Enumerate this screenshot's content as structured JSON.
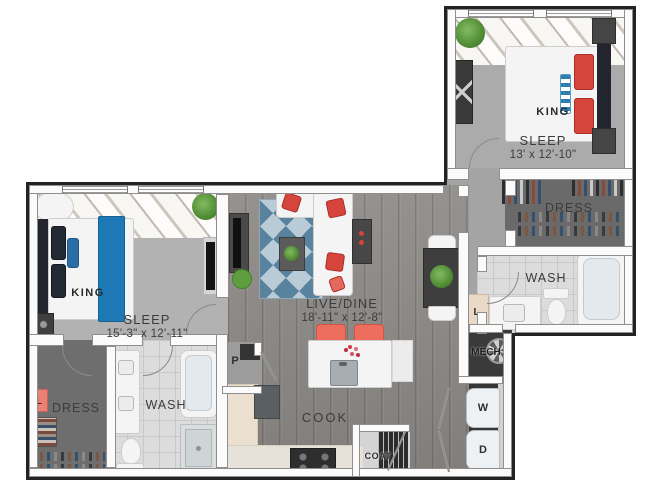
{
  "rooms": {
    "bedroom2": {
      "bed": "KING",
      "name": "SLEEP",
      "dims": "13' x 12'-10\""
    },
    "bedroom1": {
      "bed": "KING",
      "name": "SLEEP",
      "dims": "15'-3\" x 12'-11\""
    },
    "living": {
      "name": "LIVE/DINE",
      "dims": "18'-11\" x 12'-8\""
    },
    "kitchen": {
      "name": "COOK"
    },
    "bath1": {
      "name": "WASH"
    },
    "bath2": {
      "name": "WASH"
    },
    "closet1": {
      "name": "DRESS"
    },
    "closet2": {
      "name": "DRESS"
    },
    "pantry": {
      "name": "P"
    },
    "linen1": {
      "name": "L"
    },
    "linen2": {
      "name": "L"
    },
    "mechanical": {
      "name": "MECH"
    },
    "coat": {
      "name": "COAT"
    },
    "washer": {
      "name": "W"
    },
    "dryer": {
      "name": "D"
    }
  },
  "colors": {
    "wall": "#fbfbfb",
    "outline": "#232323",
    "carpet": "#b2b2b2",
    "wood_floor": "#8f8c89",
    "tile": "#dcdcdc",
    "closet_floor": "#6a6a6a",
    "accent_red": "#d5453c",
    "accent_coral": "#ee6e5d",
    "accent_blue": "#1e79b6",
    "rug_blue": "#59829f",
    "plant_green": "#4f8b34",
    "counter_cream": "#ebdfcf",
    "linen_coral": "#e98175",
    "linen_beige": "#e9d9c6"
  }
}
